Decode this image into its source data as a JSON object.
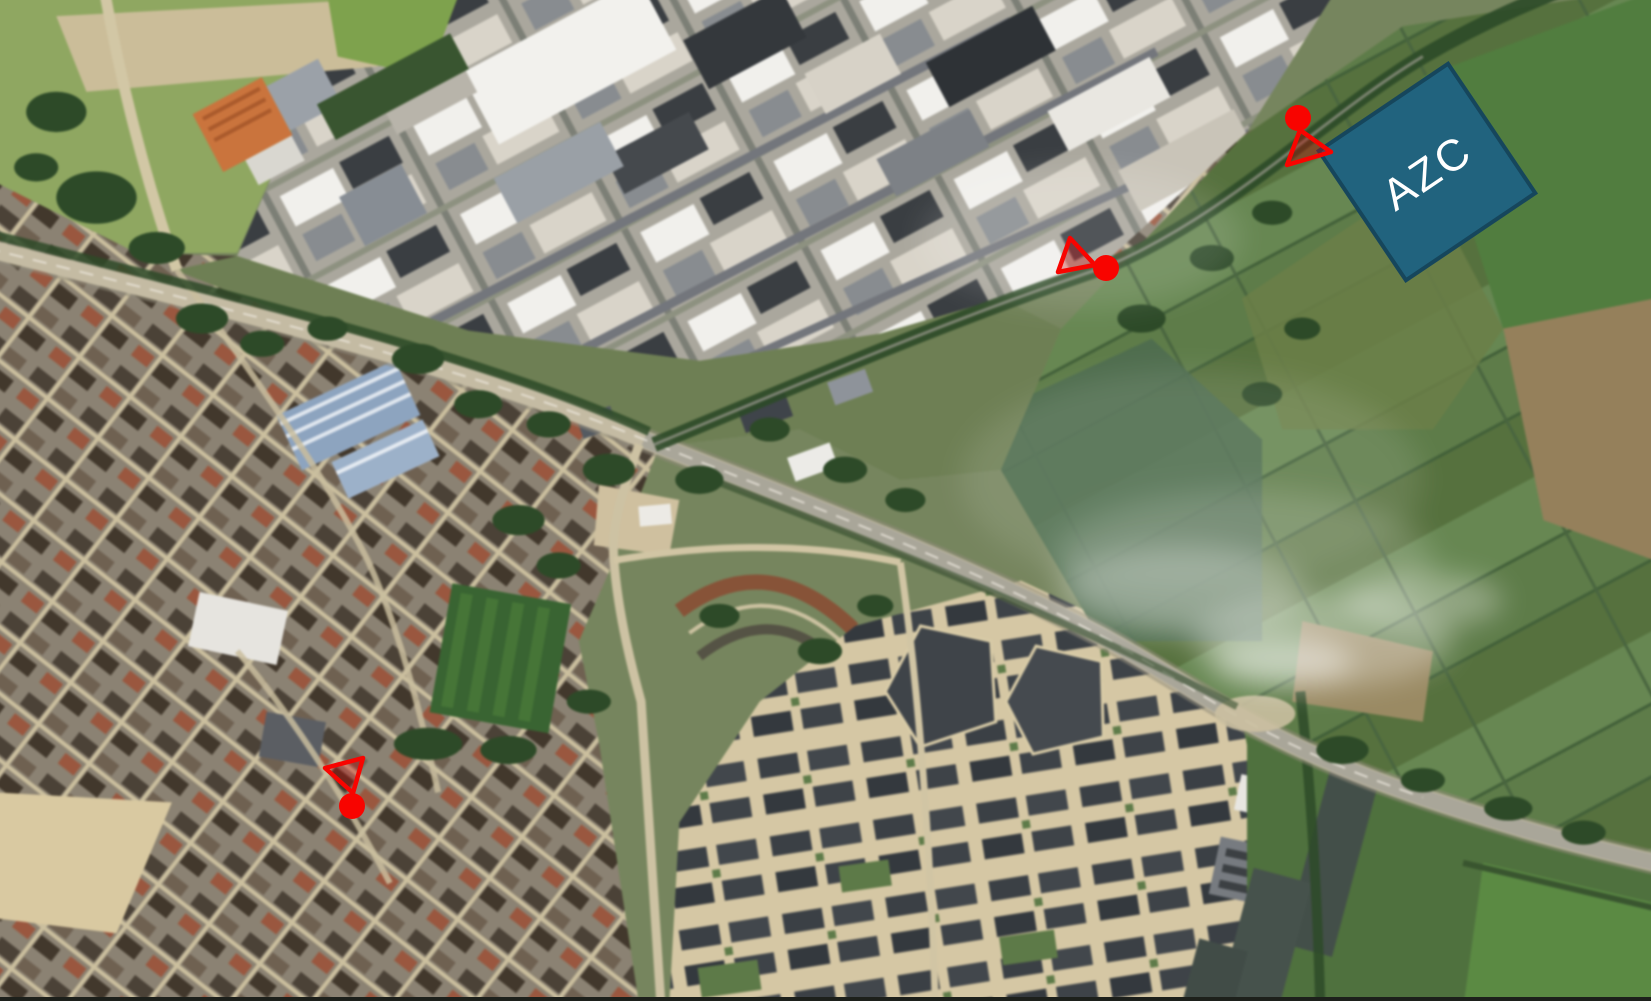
{
  "map": {
    "kind": "satellite-aerial-photo",
    "accent_colors": {
      "annotation_red": "#F80400",
      "annotation_blue": "#21637E"
    }
  },
  "azc_site": {
    "label": "AZC",
    "fill": "#21637E",
    "border": "#16465C",
    "border_width": 4,
    "text_color": "#FFFFFF",
    "center_x": 1427,
    "center_y": 172,
    "size": 156,
    "rotation_deg": -34,
    "font_size": 44,
    "letter_spacing": 3
  },
  "markers": {
    "color": "#F80400",
    "cone_fill": "#D40000",
    "cone_fill_opacity": 0.32,
    "stroke_width": 4.5,
    "items": [
      {
        "name": "marker-north-near-azc",
        "circle": {
          "cx": 1298,
          "cy": 118,
          "r": 13
        },
        "cone": [
          [
            1300,
            130
          ],
          [
            1287,
            165
          ],
          [
            1331,
            152
          ]
        ]
      },
      {
        "name": "marker-industrial-road",
        "circle": {
          "cx": 1106,
          "cy": 268,
          "r": 13
        },
        "cone": [
          [
            1095,
            265
          ],
          [
            1070,
            238
          ],
          [
            1058,
            272
          ]
        ]
      },
      {
        "name": "marker-town-centre",
        "circle": {
          "cx": 352,
          "cy": 806,
          "r": 13
        },
        "cone": [
          [
            353,
            793
          ],
          [
            325,
            768
          ],
          [
            363,
            758
          ]
        ]
      }
    ]
  }
}
